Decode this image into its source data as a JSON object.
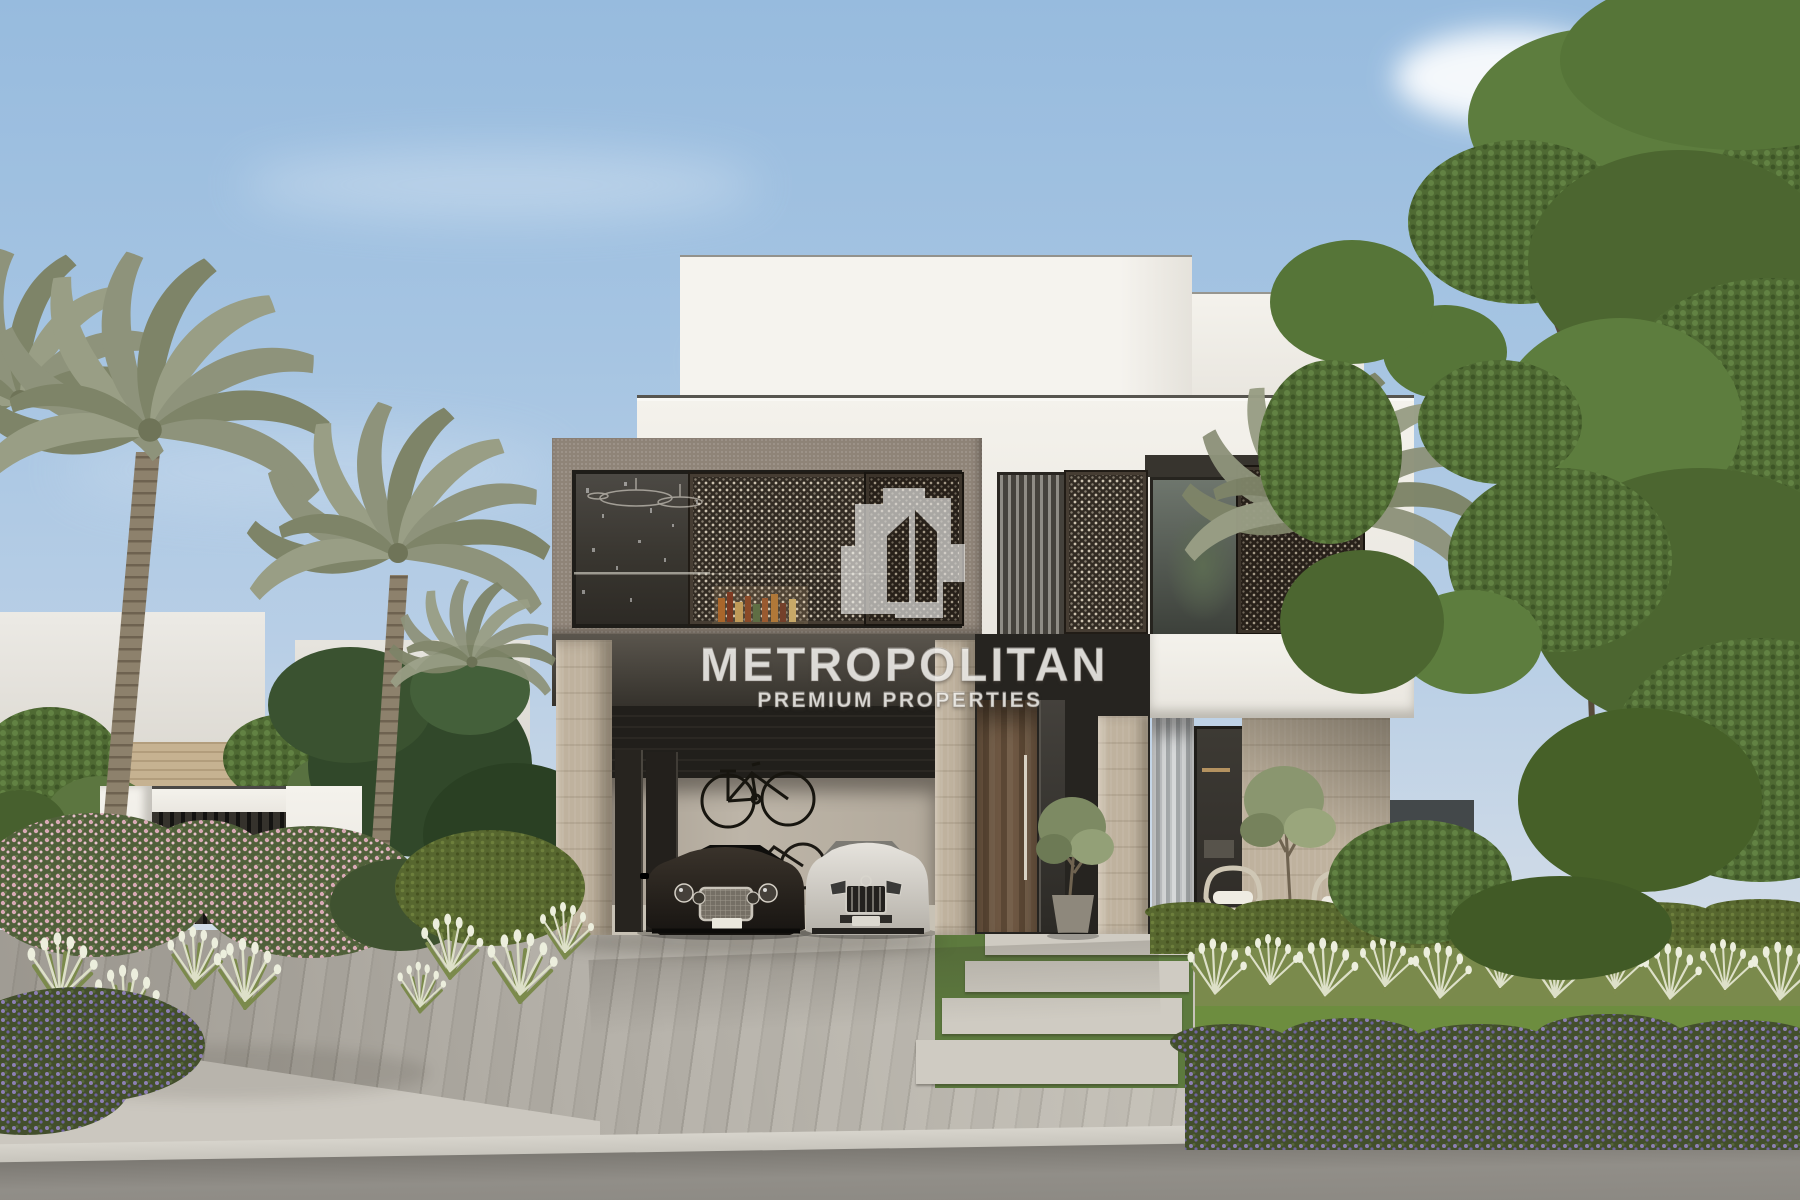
{
  "watermark": {
    "brand": "METROPOLITAN",
    "tagline": "PREMIUM PROPERTIES",
    "logo": "overlapping-buildings-glyph",
    "text_color": "rgba(255,255,255,0.8)"
  },
  "scene": {
    "type": "architectural-exterior-rendering",
    "subject": "Modern two-storey luxury villa with cantilevered balcony box, open garage with two luxury cars, palm trees and landscaped front garden",
    "time_of_day": "daytime, clear sky",
    "palette": {
      "sky_top": "#97bbde",
      "sky_horizon": "#d8e0e8",
      "villa_white": "#f2f0ea",
      "balcony_frame_taupe": "#8f8478",
      "mashrabiya_dark": "#2b251f",
      "mashrabiya_dots": "#d8cfbd",
      "glass_dark": "#393630",
      "travertine_stone": "#bfb29e",
      "wood_door": "#6d5843",
      "driveway_pavers": "#b2aea6",
      "asphalt_road": "#8a877f",
      "hedge_green": "#57672f",
      "tree_green": "#4f6a33",
      "palm_olive": "#8e937b",
      "plume_cream": "#e3e4d2",
      "flower_pink": "#d9aab6",
      "flower_purple": "#8d80b5",
      "dark_car": "#2e2823",
      "white_car": "#dbd8d1"
    },
    "elements": [
      "sky",
      "clouds",
      "neighbor-white-wall",
      "brick-band-wall",
      "entrance-gate",
      "date-palm-trees",
      "white-roof-tiers",
      "taupe-balcony-frame",
      "balcony-glazing",
      "chandelier-reflection",
      "bar-bottles",
      "mashrabiya-sliding-screens",
      "right-wing-curtain-window",
      "tree-reflection-window",
      "garage-opening",
      "wall-mounted-bicycles",
      "dark-luxury-coupe",
      "white-luxury-sedan",
      "travertine-columns",
      "wood-pivot-entrance-door",
      "potted-olive-tree",
      "vertical-louver-screen",
      "living-room-window",
      "travertine-feature-wall",
      "outdoor-wicker-chairs",
      "boxwood-hedge-row",
      "fountain-grass-row",
      "lawn-strip",
      "purple-flower-shrubs",
      "pink-flower-shrubs",
      "stepping-stone-path",
      "paver-driveway",
      "sidewalk-curb",
      "asphalt-road",
      "large-green-tree"
    ]
  }
}
